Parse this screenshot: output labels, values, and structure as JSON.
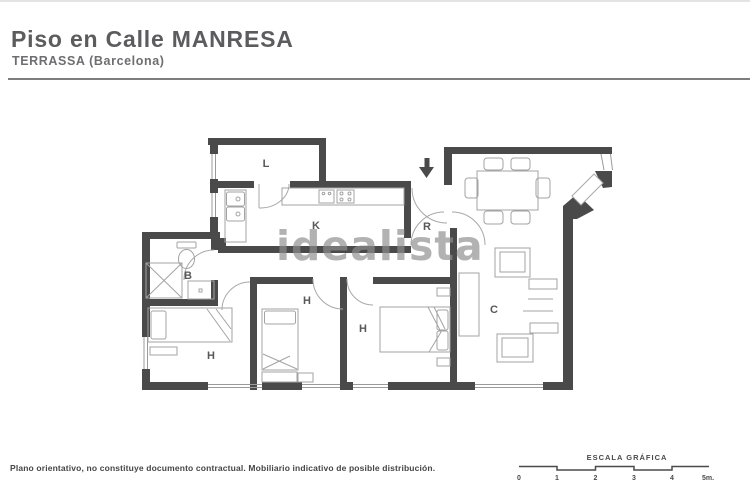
{
  "header": {
    "title": "Piso en Calle MANRESA",
    "subtitle": "TERRASSA (Barcelona)"
  },
  "watermark": "idealista",
  "rooms": [
    {
      "key": "laundry",
      "label": "L"
    },
    {
      "key": "kitchen",
      "label": "K"
    },
    {
      "key": "hall-recibidor",
      "label": "R"
    },
    {
      "key": "bathroom",
      "label": "B"
    },
    {
      "key": "living-dining",
      "label": "C"
    },
    {
      "key": "bedroom-1",
      "label": "H"
    },
    {
      "key": "bedroom-2",
      "label": "H"
    },
    {
      "key": "bedroom-3",
      "label": "H"
    }
  ],
  "icons": {
    "entrance_arrow": "down-arrow"
  },
  "scale": {
    "title": "ESCALA GRÁFICA",
    "ticks": [
      "0",
      "1",
      "2",
      "3",
      "4",
      "5m."
    ]
  },
  "footer": {
    "disclaimer": "Plano orientativo, no constituye documento contractual. Mobiliario indicativo de posible distribución."
  },
  "colors": {
    "wall": "#4a4a4a",
    "furniture_line": "#a3a3a3",
    "room_label": "#58585a",
    "title_text": "#5c5c5e",
    "watermark": "#8f8f8f"
  }
}
